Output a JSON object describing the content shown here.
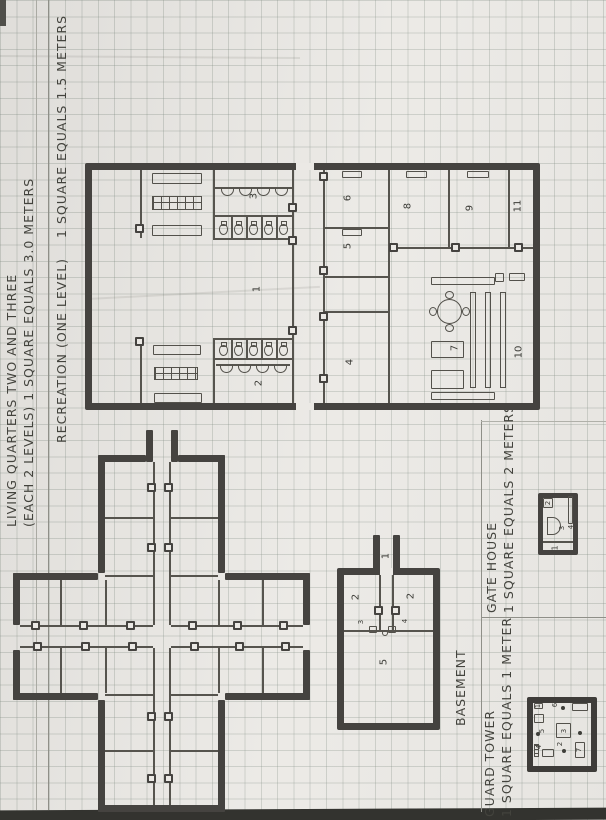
{
  "document": {
    "type": "hand-drawn floor plan on graph paper",
    "colors": {
      "paper": "#ebe9e5",
      "grid": "#808c82",
      "wall_ink": "#454340",
      "thin_ink": "#56544e",
      "pencil_text": "#43433d",
      "scan_edge": "#33332f"
    }
  },
  "titles": {
    "living_quarters_line1": "LIVING QUARTERS TWO AND THREE",
    "living_quarters_line2": "(EACH 2 LEVELS) 1 SQUARE EQUALS 3.0 METERS",
    "recreation_name": "RECREATION (ONE LEVEL)",
    "recreation_scale": "1 SQUARE EQUALS 1.5 METERS",
    "basement": "BASEMENT",
    "gate_house_name": "GATE HOUSE",
    "gate_house_scale": "1 SQUARE EQUALS 2 METERS",
    "guard_tower_name": "GUARD TOWER",
    "guard_tower_scale": "1 SQUARE EQUALS 1 METER"
  },
  "recreation": {
    "rooms": [
      "1",
      "2",
      "3",
      "4",
      "5",
      "6",
      "7",
      "8",
      "9",
      "10",
      "11"
    ]
  },
  "basement": {
    "rooms": {
      "stair": "1",
      "left": "2",
      "right": "2",
      "door_left": "3",
      "door_right": "4",
      "main": "5"
    }
  },
  "gate_house": {
    "rooms": {
      "main": "1",
      "closet": "2",
      "desk": "3",
      "gate": "4"
    }
  },
  "guard_tower": {
    "items": {
      "i1": "1",
      "i2": "2",
      "i3": "3",
      "i4": "4",
      "i5": "5",
      "i6": "6",
      "i7": "7"
    }
  }
}
